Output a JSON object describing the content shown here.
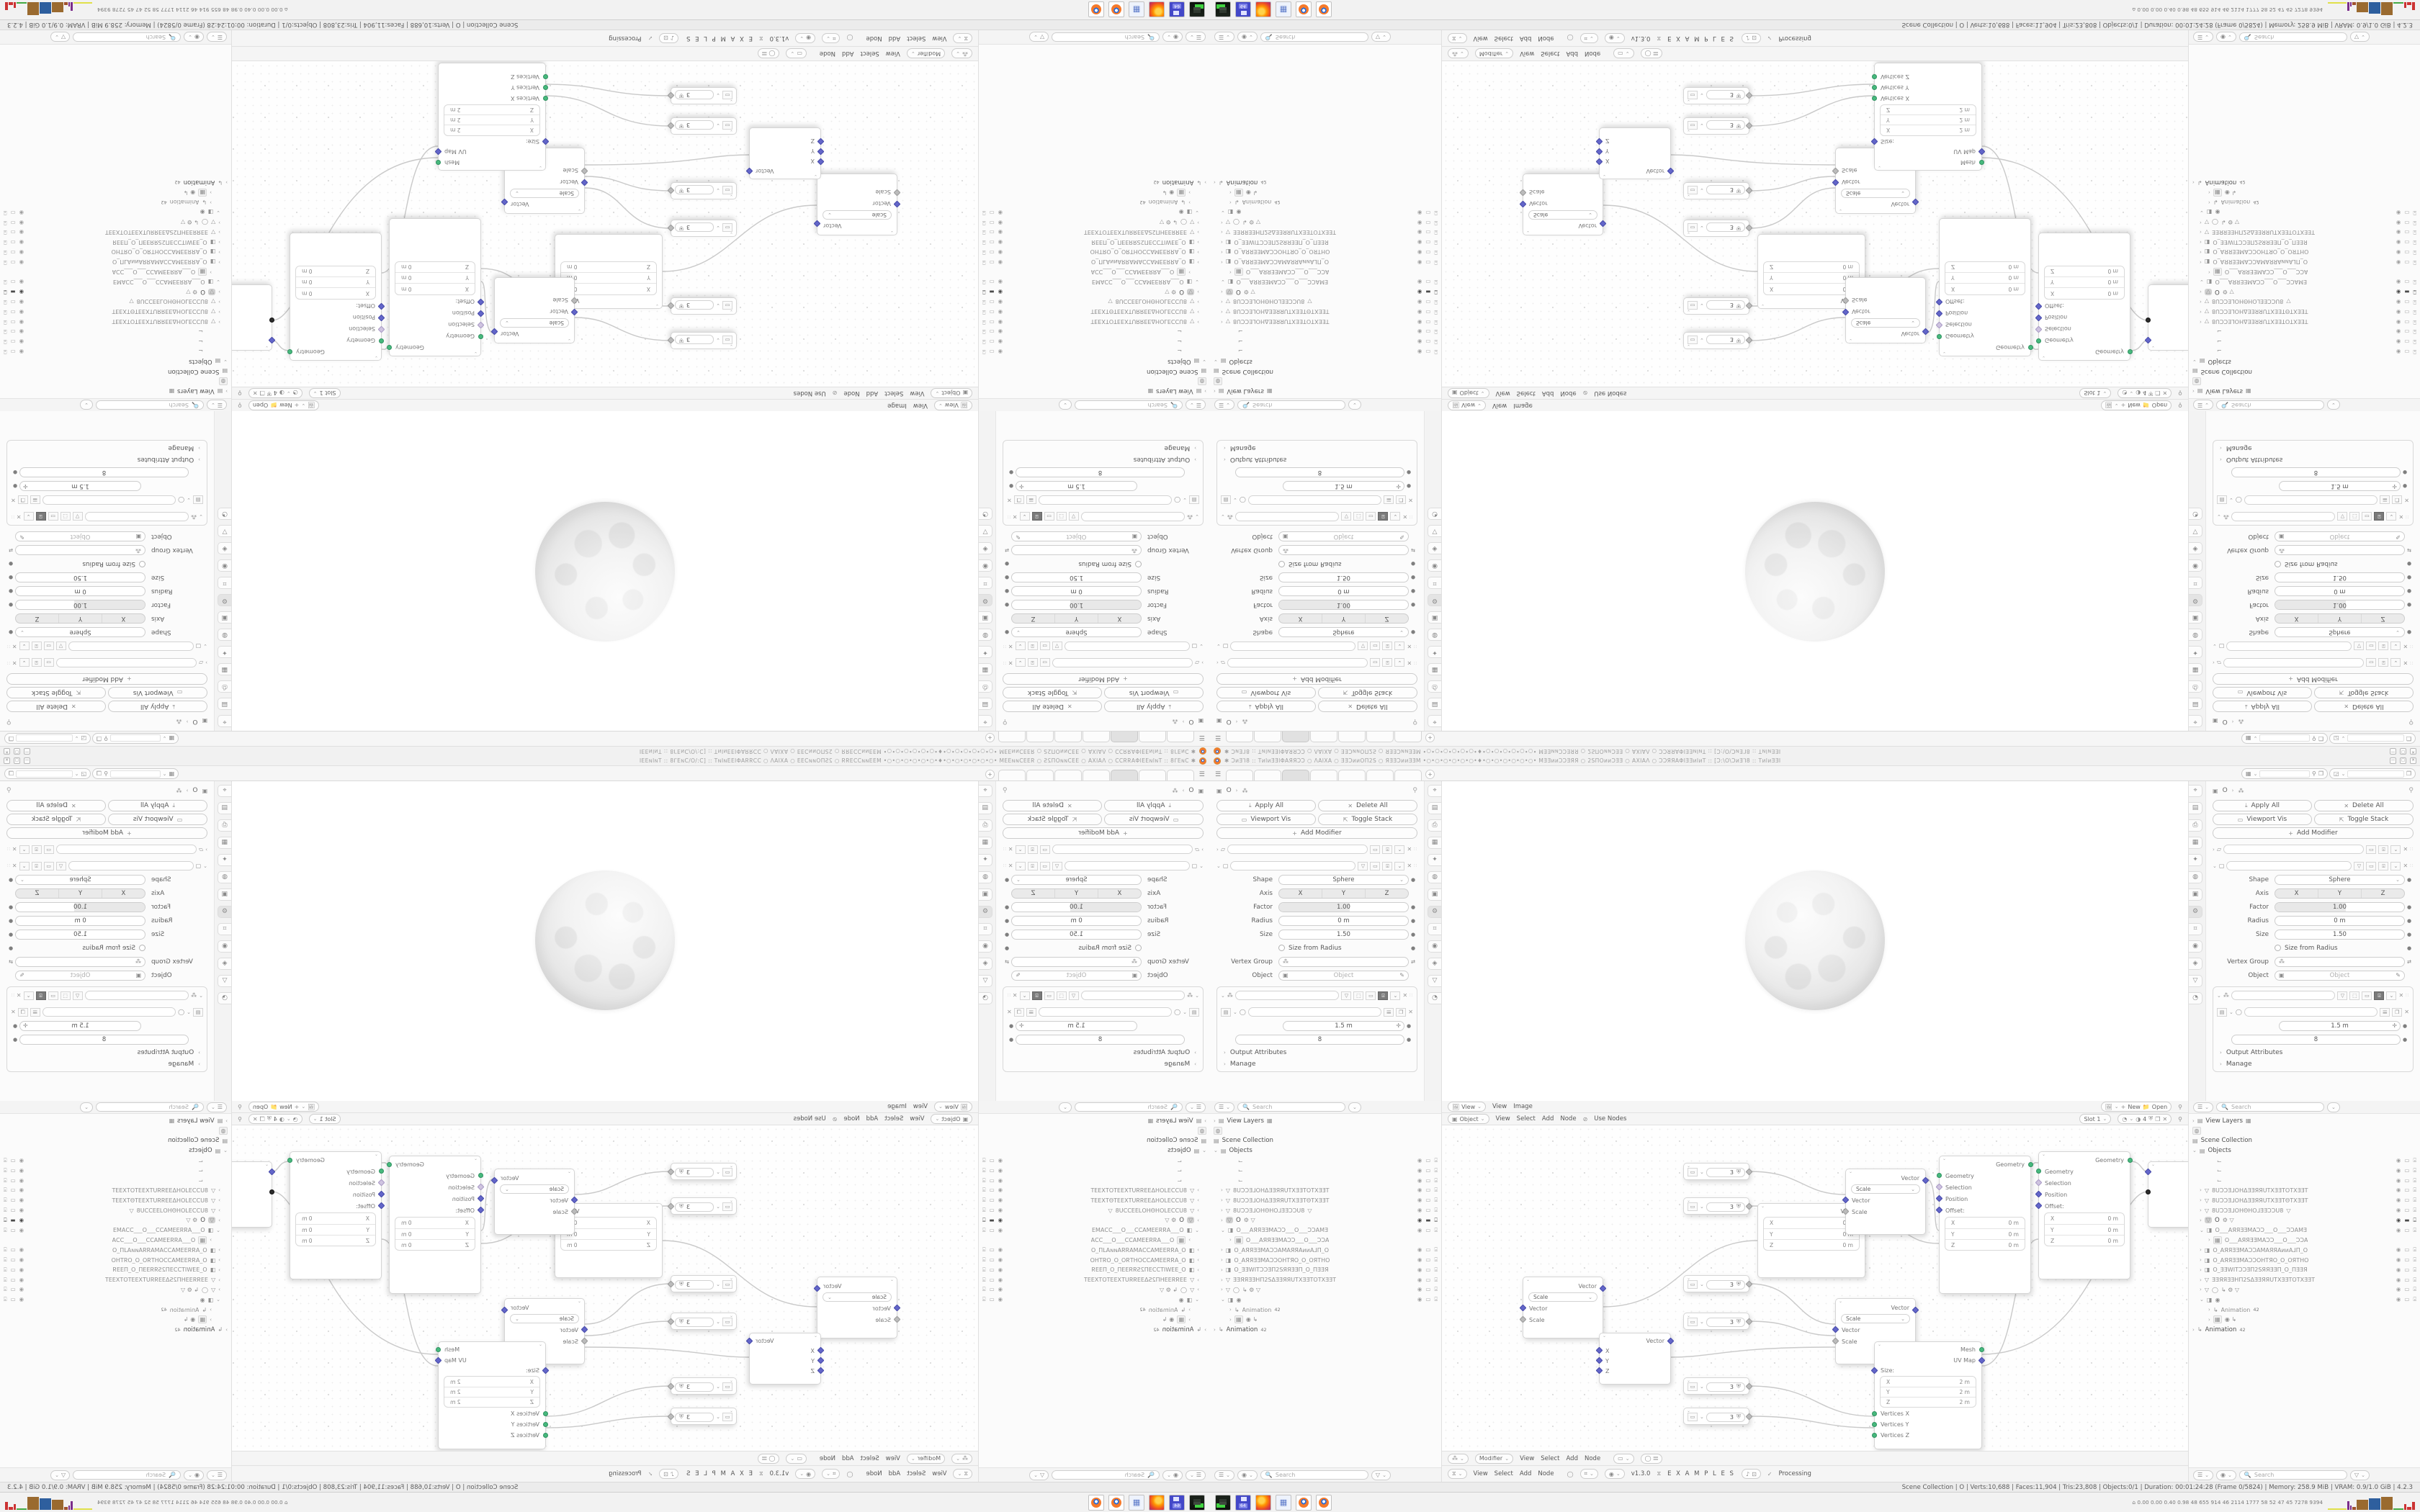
{
  "titlebar": {
    "title_text": "✱ ƆᴎƎ⅂8 :: TᴎIᴎƎƎIΦAЯЯƆƆ ○ ΛAIXA ○ ƎƎƆᴎᴎOΠ2S ○ ЯƎƎƆᴎᴎƎƎM •○•○•○•○•○•○•♦•○•○•○•○•○•○• MƎƎᴎᴎƆƆƎЯЯ ○ 2SΠOᴎᴎƆƎƎ ○ AXIAΛ ○ ƆƆЯЯAΦIƎƎᴎIᴎT :: [Ɔ:\\O\\ƆᴎƎ⅂8 :: TᴎIᴎƎƎI",
    "btn_min": "—",
    "btn_max": "▢",
    "btn_close": "✕"
  },
  "topbar": {
    "menu_icon": "☰",
    "add_tab": "+"
  },
  "properties": {
    "crumb_obj": "O",
    "btn_apply": "Apply All",
    "btn_delete": "Delete All",
    "btn_vis": "Viewport Vis",
    "btn_stack": "Toggle Stack",
    "btn_add": "Add Modifier",
    "shape_label": "Shape",
    "shape_value": "Sphere",
    "axis_label": "Axis",
    "axis": [
      "X",
      "Y",
      "Z"
    ],
    "factor_label": "Factor",
    "factor_value": "1.00",
    "radius_label": "Radius",
    "radius_value": "0 m",
    "size_label": "Size",
    "size_value": "1.50",
    "size_from_radius": "Size from Radius",
    "vgroup_label": "Vertex Group",
    "object_label": "Object",
    "object_placeholder": "Object",
    "spacing_value": "1.5 m",
    "count_value": "8",
    "output_attrs": "Output Attributes",
    "manage": "Manage",
    "search_placeholder": "Search"
  },
  "outliner": {
    "search_placeholder": "Search",
    "view_layers": "View Layers",
    "scene_collection": "Scene Collection",
    "objects": "Objects",
    "rows": [
      {
        "name": ""
      },
      {
        "name": ""
      },
      {
        "name": ""
      },
      {
        "name": "8UƆƆƎ⅃OHΔƎƎЯЯUTXƎƎTOTXƎƎT"
      },
      {
        "name": "8UƆƆƎ⅃OHΔƎƎЯЯUTXƎƎTΘTXƎƎT"
      },
      {
        "name": "8UƆƆƎ⅃OHΘHO⅃ƎƎƆƆU8",
        "extra": "▽"
      },
      {
        "name": "O",
        "extra": "⚙ ▽"
      },
      {
        "name": "O___AЯЯƎƎMAƆƆ___O___ƆƆAMƎ"
      },
      {
        "name": "O___AЯЯƎƎMAƆƆ___O___ƆƆA"
      },
      {
        "name": "O_AЯЯƎƎMAƆƆAMAЯЯAᴎᴎA⅃Π_O"
      },
      {
        "name": "O_AЯЯƎƎMAƆƆOHTЯO_O_OЯTHO"
      },
      {
        "name": "O_ƎƎWITƆƆƎΠ2SЯЯƎƎΠ_O_ΠƎƎЯ"
      },
      {
        "name": "ƎƎЯЯƎƎHΠ2SΔƎƎЯЯUTXƎƎTOTXƎƎT"
      },
      {
        "name": "◯",
        "extra": "↳ ⚙ ▽"
      },
      {
        "name": "◉"
      },
      {
        "name": "Animation",
        "badge": "42"
      },
      {
        "name": "◉   ↳"
      },
      {
        "name": "Animation",
        "badge": "42"
      }
    ]
  },
  "image_editor": {
    "mode": "View",
    "menu_view": "View",
    "menu_image": "Image",
    "btn_new": "New",
    "btn_open": "Open"
  },
  "shader_editor": {
    "mode": "Object",
    "menu_view": "View",
    "menu_select": "Select",
    "menu_add": "Add",
    "menu_node": "Node",
    "use_nodes": "Use Nodes",
    "slot": "Slot 1",
    "badge": "4"
  },
  "geo_editor": {
    "mode": "Modifier",
    "menu_view": "View",
    "menu_select": "Select",
    "menu_add": "Add",
    "menu_node": "Node"
  },
  "timeline": {
    "menu_view": "View",
    "menu_select": "Select",
    "menu_add": "Add",
    "menu_node": "Node",
    "version": "v1.3.0",
    "examples": "E X A M P L E S",
    "processing": "Processing"
  },
  "statusbar": {
    "stats": "Scene Collection | O | Verts:10,688 | Faces:11,904 | Tris:23,808 | Objects:0/1 | Duration: 00:01:24:28 (Frame 0/5824) | Memory: 258.9 MiB | VRAM: 0.9/1.0 GiB | 4.2.3"
  },
  "taskbar": {
    "profiler": "⌂  0.00 0.00 0.40 0.98   48   655   914   46   2114 1777   58   52   47   45   7278 9394"
  },
  "node_editor": {
    "value_node": {
      "value": "3"
    },
    "combine": {
      "out": "Vector",
      "in_x": "X",
      "in_y": "Y",
      "in_z": "Z"
    },
    "scale": {
      "out": "Vector",
      "select": "Scale",
      "in_vector": "Vector",
      "in_scale": "Scale"
    },
    "setpos": {
      "out": "Geometry",
      "in_geometry": "Geometry",
      "in_selection": "Selection",
      "in_position": "Position",
      "in_offset": "Offset:",
      "rows": [
        [
          "X",
          "0 m"
        ],
        [
          "Y",
          "0 m"
        ],
        [
          "Z",
          "0 m"
        ]
      ]
    },
    "grid": {
      "out_mesh": "Mesh",
      "out_uv": "UV Map",
      "size_label": "Size:",
      "rows": [
        [
          "X",
          "2 m"
        ],
        [
          "Y",
          "2 m"
        ],
        [
          "Z",
          "2 m"
        ]
      ],
      "in_vx": "Vertices X",
      "in_vy": "Vertices Y",
      "in_vz": "Vertices Z"
    }
  },
  "colors": {
    "accent_green": "#47b97d",
    "accent_indigo": "#6366c9",
    "accent_lavender": "#cfc4e0",
    "hist_yellow": "#e0e04a",
    "hist_purple": "#7b2d8b",
    "hist_brown": "#9a6a2f",
    "hist_blue": "#2e5f9e",
    "hist_green": "#44aa44",
    "hist_red": "#cc3333"
  }
}
